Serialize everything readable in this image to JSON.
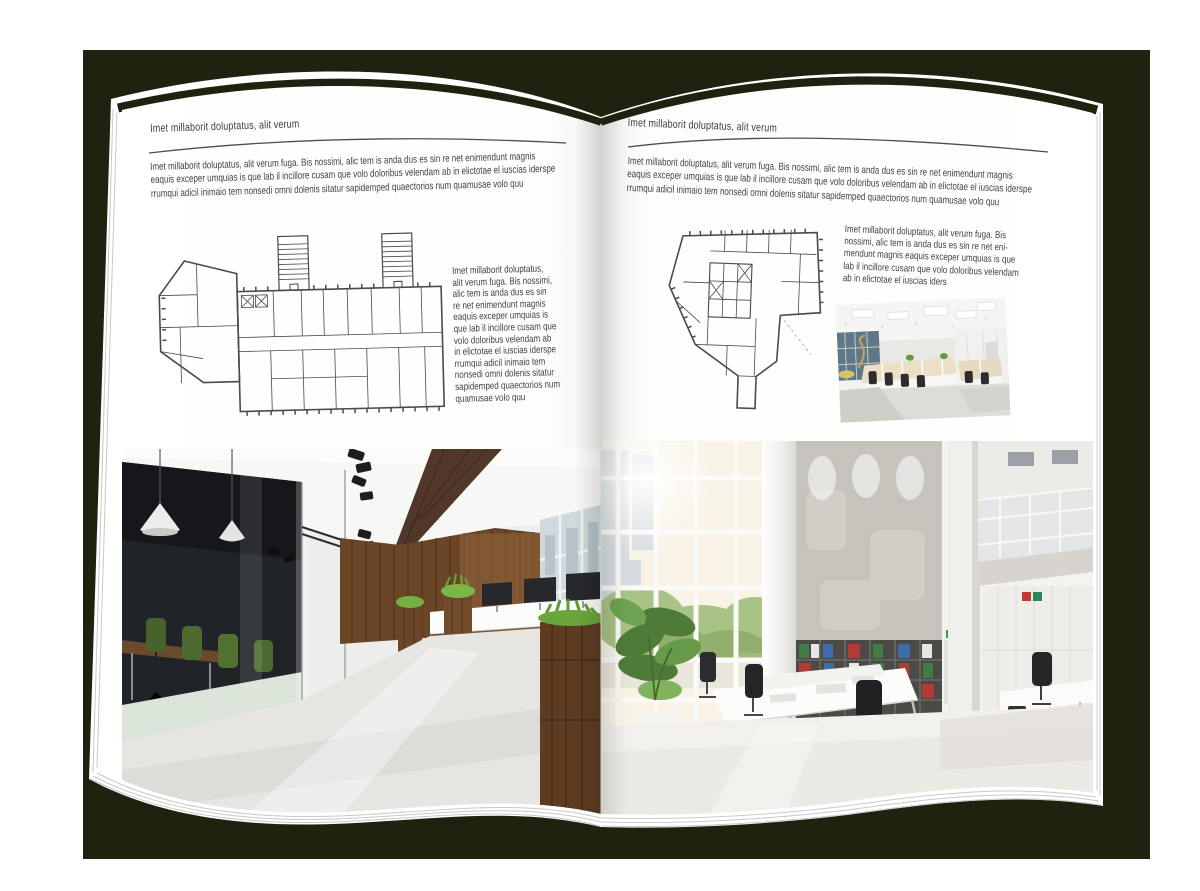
{
  "book": {
    "left_page": {
      "header": "Imet millaborit doluptatus, alit verum",
      "intro": "Imet millaborit doluptatus, alit verum fuga. Bis nossimi, alic tem is anda dus es sin re net enimendunt magnis\neaquis exceper umquias is que lab il incillore cusam que volo doloribus velendam ab in elictotae el iuscias iderspe\nrrumqui adicil inimaio tem nonsedi omni dolenis sitatur sapidemped quaectorios num quamusae volo quu",
      "side_text": "Imet millaborit doluptatus,\nalit verum fuga. Bis nossimi,\nalic tem is anda dus es sin\nre net enimendunt magnis\neaquis exceper umquias is\nque lab il incillore cusam que\nvolo doloribus velendam ab\nin elictotae el iuscias iderspe\nrrumqui adicil inimaio tem\nnonsedi omni dolenis sitatur\nsapidemped quaectorios num\nquamusae volo quu"
    },
    "right_page": {
      "header": "Imet millaborit doluptatus, alit verum",
      "intro": "Imet millaborit doluptatus, alit verum fuga. Bis nossimi, alic tem is anda dus es sin re net enimendunt magnis\neaquis exceper umquias is que lab il incillore cusam que volo doloribus velendam ab in elictotae el iuscias iderspe\nrrumqui adicil inimaio tem nonsedi omni dolenis sitatur sapidemped quaectorios num quamusae volo quu",
      "side_text": "Imet millaborit doluptatus, alit verum fuga. Bis\nnossimi, alic tem is anda dus es sin re net eni-\nmendunt magnis eaquis exceper umquias is que\nlab il incillore cusam que volo doloribus velendam\nab in elictotae el iuscias iders"
    }
  },
  "colors": {
    "backdrop": "#20220f",
    "page": "#ffffff",
    "body_text": "#3f3f3f",
    "rule": "#4f4f4f",
    "wood": "#5d3d26",
    "plant_green": "#76b043",
    "chair_green": "#4c6a2f",
    "binder_green": "#3f7d44",
    "binder_blue": "#3f6cad",
    "binder_red": "#b23b34"
  }
}
